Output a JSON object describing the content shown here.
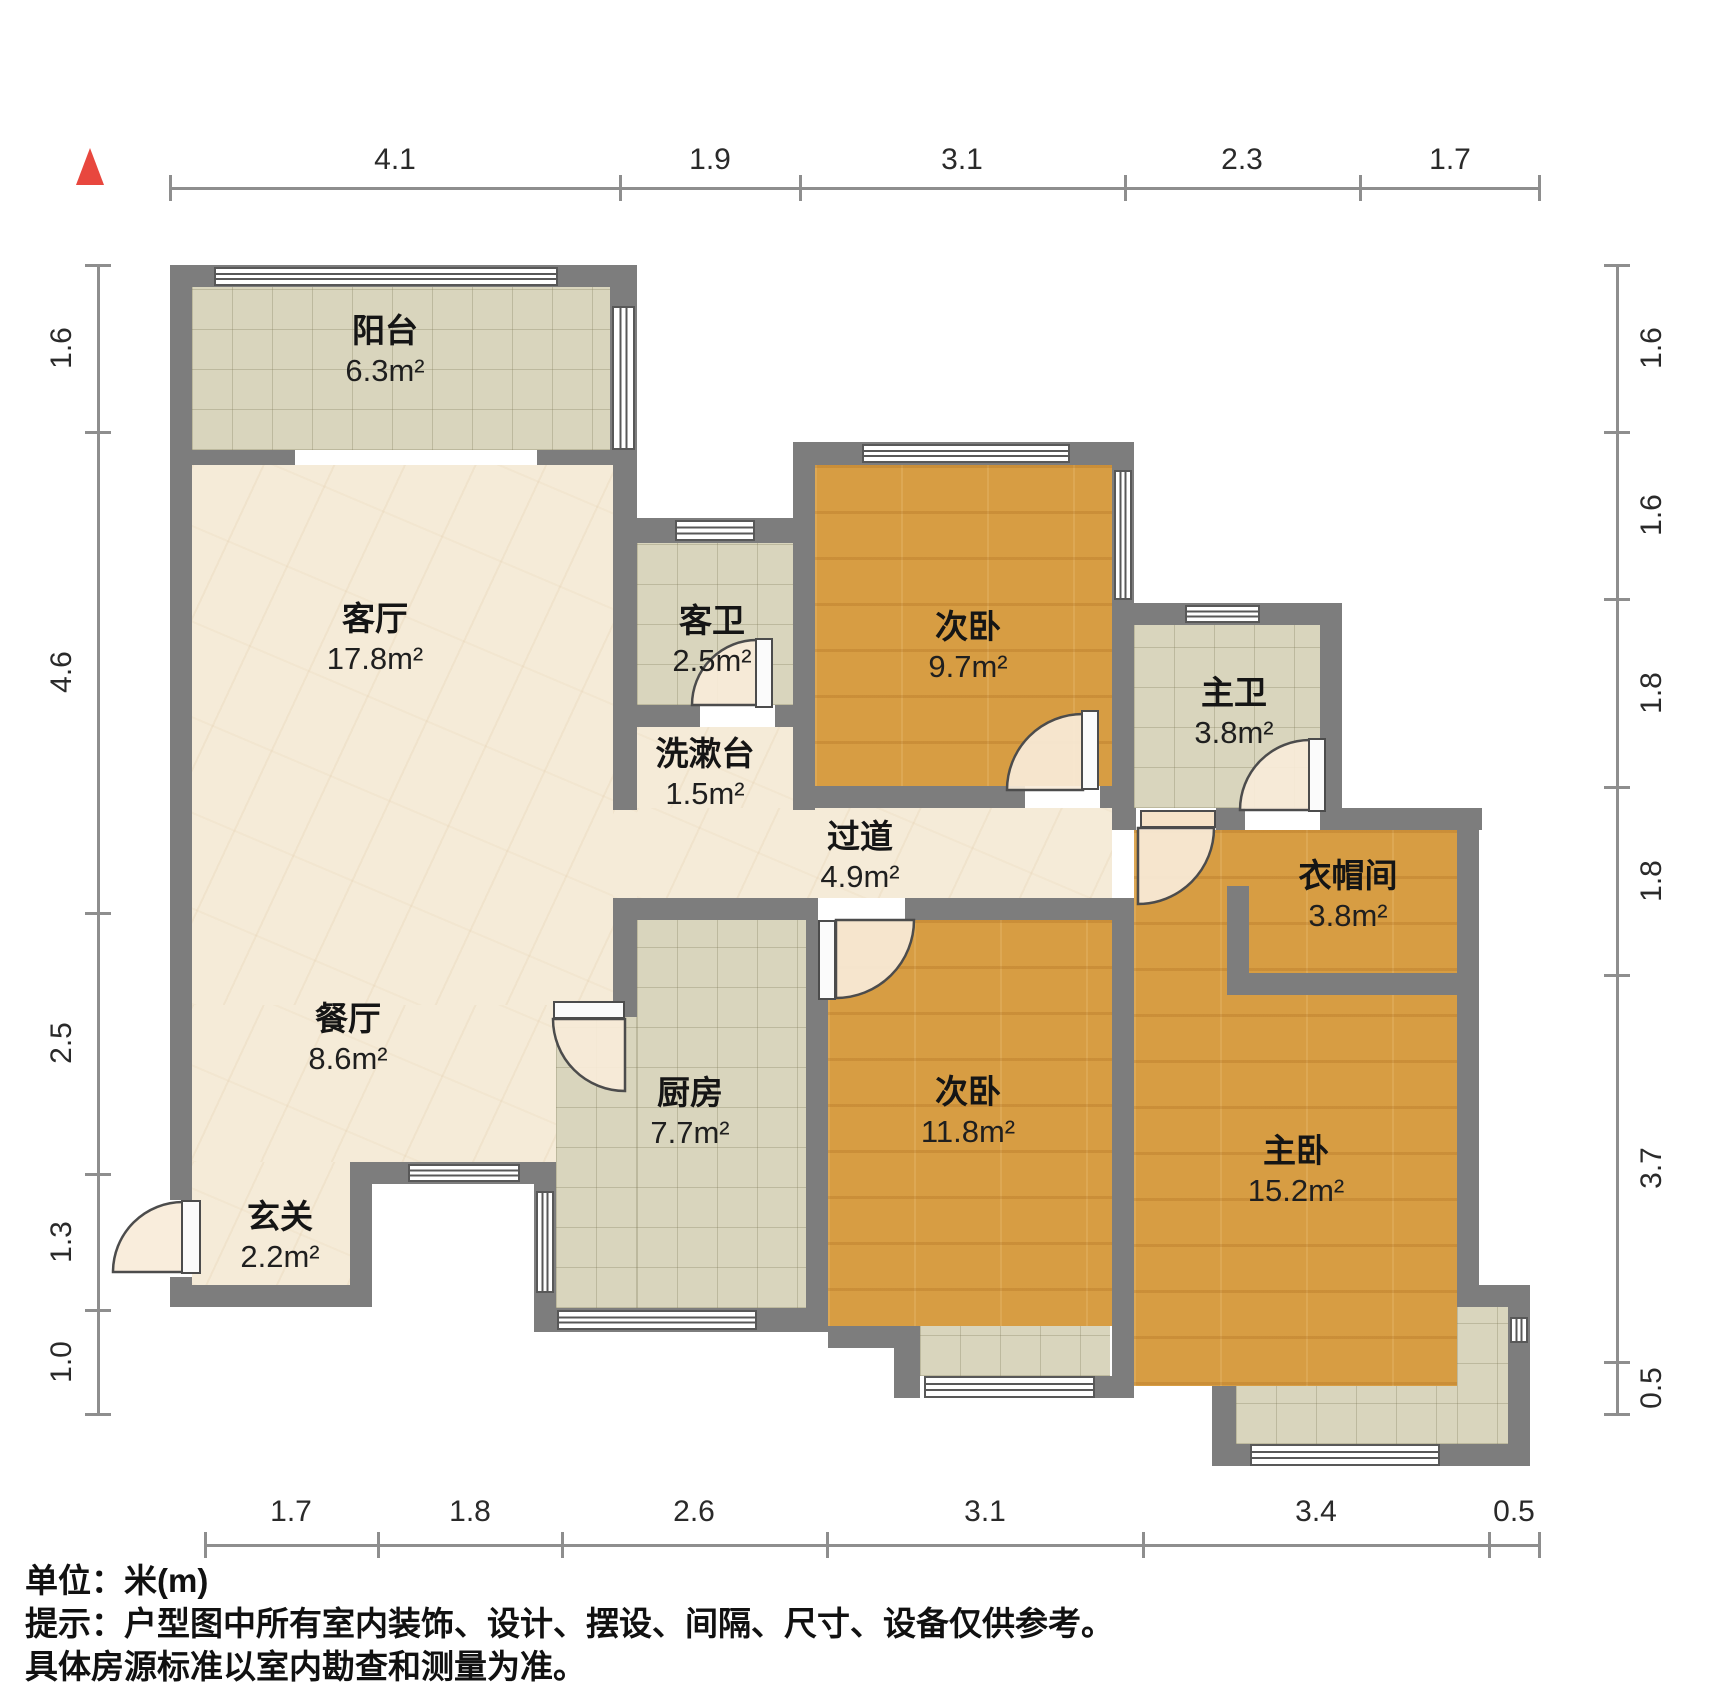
{
  "title": "户型图",
  "unit_note": "单位：米(m)",
  "disclaimer_line1": "提示：户型图中所有室内装饰、设计、摆设、间隔、尺寸、设备仅供参考。",
  "disclaimer_line2": "具体房源标准以室内勘查和测量为准。",
  "rooms": [
    {
      "id": "balcony",
      "name": "阳台",
      "area": "6.3m²"
    },
    {
      "id": "living-room",
      "name": "客厅",
      "area": "17.8m²"
    },
    {
      "id": "guest-bath",
      "name": "客卫",
      "area": "2.5m²"
    },
    {
      "id": "washstand",
      "name": "洗漱台",
      "area": "1.5m²"
    },
    {
      "id": "bedroom-2a",
      "name": "次卧",
      "area": "9.7m²"
    },
    {
      "id": "master-bath",
      "name": "主卫",
      "area": "3.8m²"
    },
    {
      "id": "hallway",
      "name": "过道",
      "area": "4.9m²"
    },
    {
      "id": "closet",
      "name": "衣帽间",
      "area": "3.8m²"
    },
    {
      "id": "dining-room",
      "name": "餐厅",
      "area": "8.6m²"
    },
    {
      "id": "kitchen",
      "name": "厨房",
      "area": "7.7m²"
    },
    {
      "id": "bedroom-2b",
      "name": "次卧",
      "area": "11.8m²"
    },
    {
      "id": "master-bed",
      "name": "主卧",
      "area": "15.2m²"
    },
    {
      "id": "entry",
      "name": "玄关",
      "area": "2.2m²"
    }
  ],
  "dimensions": {
    "top": [
      "4.1",
      "1.9",
      "3.1",
      "2.3",
      "1.7"
    ],
    "bottom": [
      "1.7",
      "1.8",
      "2.6",
      "3.1",
      "3.4",
      "0.5"
    ],
    "left": [
      "1.6",
      "4.6",
      "2.5",
      "1.3",
      "1.0"
    ],
    "right": [
      "1.6",
      "1.6",
      "1.8",
      "1.8",
      "3.7",
      "0.5"
    ]
  },
  "colors": {
    "wall": "#7d7d7d",
    "wood_floor": "#d79d43",
    "tile_floor": "#d9d5bd",
    "marble_floor": "#f5ebd8",
    "north_arrow": "#e8473e",
    "dim_line": "#8e8e8e"
  }
}
